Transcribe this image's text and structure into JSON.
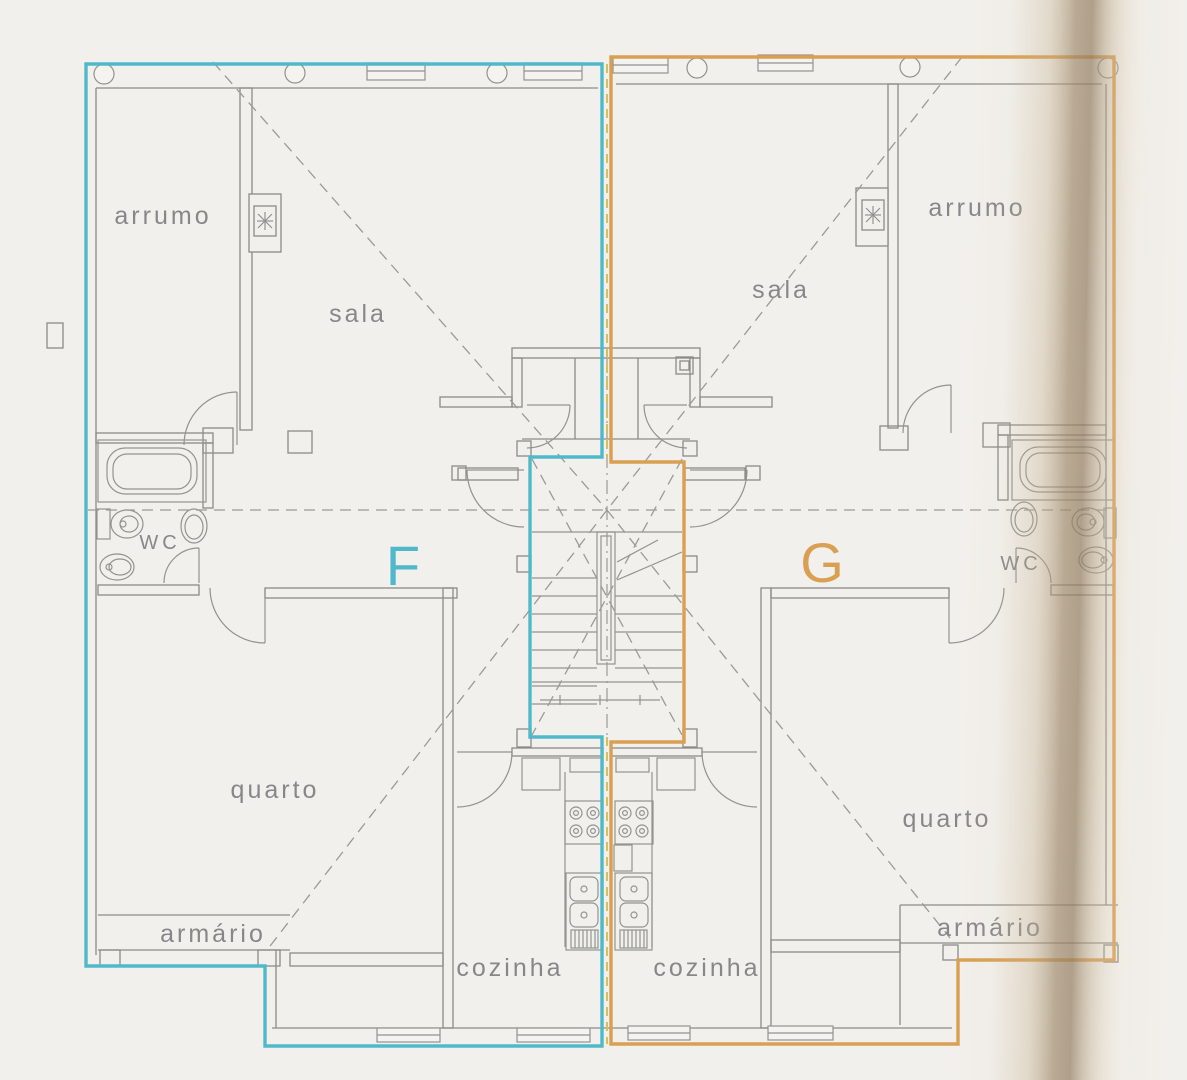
{
  "plan": {
    "unit_f": {
      "label": "F",
      "accent": "#4fb9c9",
      "rooms": {
        "arrumo": "arrumo",
        "sala": "sala",
        "wc": "WC",
        "quarto": "quarto",
        "armario": "armário",
        "cozinha": "cozinha"
      }
    },
    "unit_g": {
      "label": "G",
      "accent": "#d99f52",
      "rooms": {
        "arrumo": "arrumo",
        "sala": "sala",
        "wc": "WC",
        "quarto": "quarto",
        "armario": "armário",
        "cozinha": "cozinha"
      }
    },
    "colors": {
      "walls": "#8b8b87",
      "dashes": "#9a9a96",
      "party_line": "#d6bf5e",
      "paper": "#f2f0ec",
      "scan_shadow": "#947f63"
    }
  }
}
